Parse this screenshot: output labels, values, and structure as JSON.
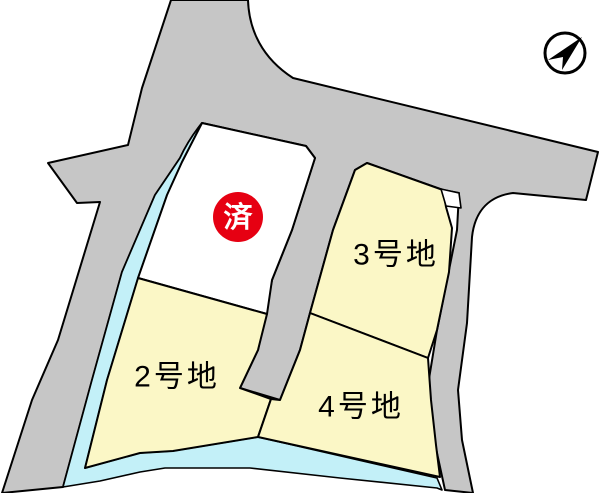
{
  "map": {
    "title": "lot-layout-map",
    "compass": {
      "icon": "north-arrow"
    },
    "sold_badge": {
      "label": "済"
    },
    "lots": {
      "lot2": {
        "label": "2号地"
      },
      "lot3": {
        "label": "3号地"
      },
      "lot4": {
        "label": "4号地"
      },
      "sold": {
        "label": ""
      }
    },
    "colors": {
      "road": "#c6c6c6",
      "water": "#c3f0f8",
      "lot_fill": "#fbf7c6",
      "sold_fill": "#ffffff",
      "notch_fill": "#ffffff",
      "badge_fill": "#e60012",
      "badge_text": "#ffffff",
      "outline": "#000000",
      "background": "#ffffff"
    }
  }
}
